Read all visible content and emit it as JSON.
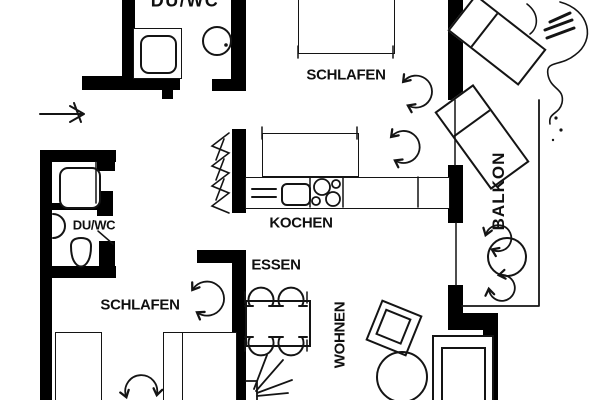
{
  "plan": {
    "background": "#ffffff",
    "wall_color": "#000000",
    "line_color": "#141414",
    "labels": {
      "bath_top": "DU/WC",
      "bedroom_top": "SCHLAFEN",
      "balcony": "BALKON",
      "kitchen": "KOCHEN",
      "bath_left": "DU/WC",
      "bedroom_bottom": "SCHLAFEN",
      "dining": "ESSEN",
      "living": "WOHNEN"
    },
    "legend_fixtures": [
      "entrance-arrow",
      "shower",
      "washbasin",
      "toilet",
      "bed",
      "wardrobe",
      "kitchen-counter",
      "sink",
      "stove",
      "shaft-hatch",
      "dining-table",
      "dining-chairs",
      "plant",
      "armchair",
      "coffee-table",
      "sofa",
      "sun-loungers",
      "balcony-table",
      "balcony-railing",
      "door-swings"
    ]
  }
}
